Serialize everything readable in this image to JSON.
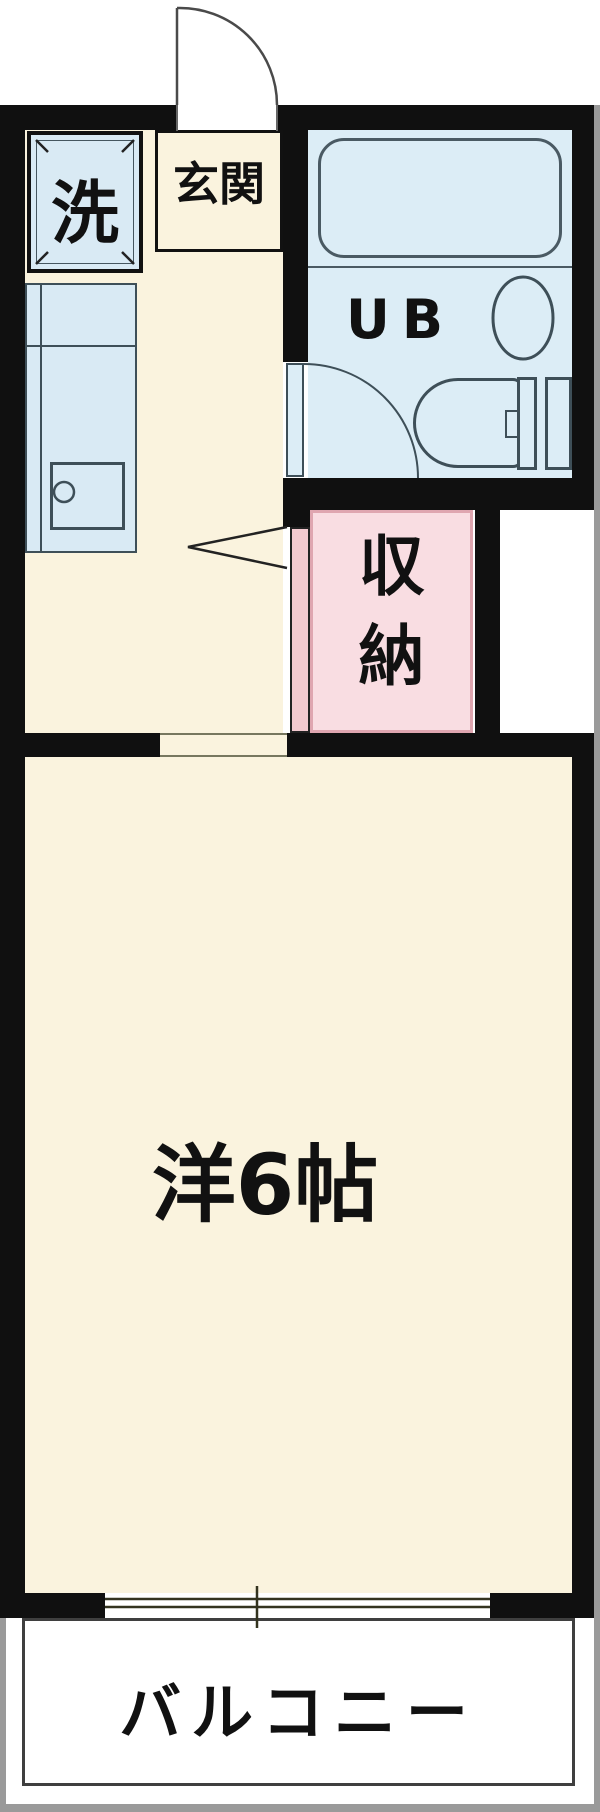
{
  "floorplan": {
    "labels": {
      "entrance": "玄関",
      "washer": "洗",
      "unit_bath": "UB",
      "storage_char1": "収",
      "storage_char2": "納",
      "main_room": "洋6帖",
      "balcony": "バルコニー"
    },
    "colors": {
      "wall_black": "#101010",
      "floor_cream": "#FAF3DE",
      "wet_area_blue": "#DCEDF6",
      "fixture_outline": "#3E4F58",
      "storage_pink": "#F9DDE2",
      "storage_pink_border": "#DFA6B0",
      "storage_door_pink": "#F3C9CF",
      "balcony_border": "#3F3F3F",
      "outer_frame_gray": "#9A9A9A"
    }
  }
}
